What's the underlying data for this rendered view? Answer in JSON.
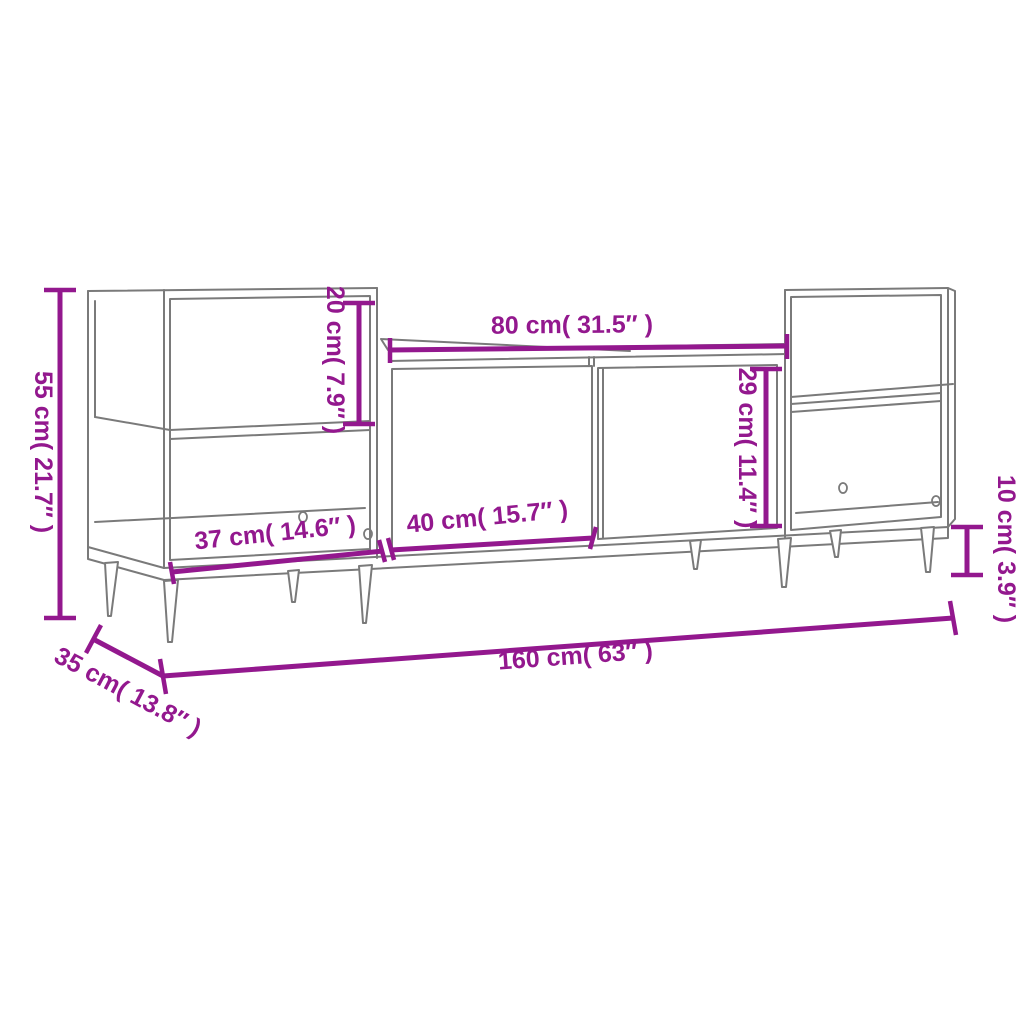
{
  "diagram": {
    "subject": "TV cabinet wireframe dimension drawing",
    "background": "#ffffff",
    "annotation_color": "#93188E",
    "line_art_color": "#7a7a7a",
    "dimensions": {
      "overall_height": {
        "label": "55 cm( 21.7″ )",
        "cm": 55,
        "inches": 21.7
      },
      "upper_shelf_height": {
        "label": "20 cm( 7.9″ )",
        "cm": 20,
        "inches": 7.9
      },
      "center_top_width": {
        "label": "80 cm( 31.5″ )",
        "cm": 80,
        "inches": 31.5
      },
      "door_height": {
        "label": "29 cm( 11.4″ )",
        "cm": 29,
        "inches": 11.4
      },
      "leg_height": {
        "label": "10 cm( 3.9″ )",
        "cm": 10,
        "inches": 3.9
      },
      "side_compartment_width": {
        "label": "37 cm( 14.6″ )",
        "cm": 37,
        "inches": 14.6
      },
      "door_width": {
        "label": "40 cm( 15.7″ )",
        "cm": 40,
        "inches": 15.7
      },
      "overall_width": {
        "label": "160 cm( 63″ )",
        "cm": 160,
        "inches": 63
      },
      "depth": {
        "label": "35 cm( 13.8″ )",
        "cm": 35,
        "inches": 13.8
      }
    }
  }
}
